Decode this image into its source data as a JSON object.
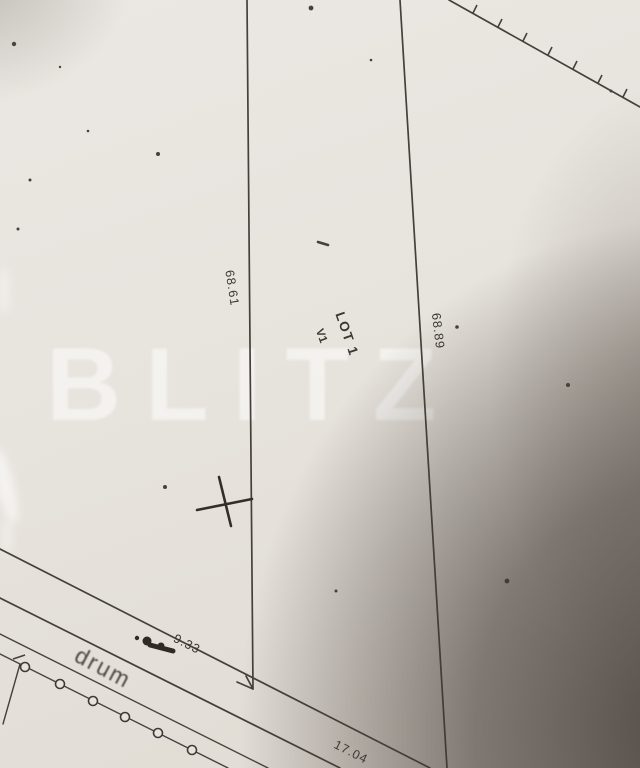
{
  "watermark": {
    "text": "BLITZ"
  },
  "labels": {
    "lot": "LOT 1",
    "vertex": "V1",
    "road": "drum",
    "left_side_length": "68.61",
    "right_side_length": "68.89",
    "road_segment_length": "9.33",
    "frontage_length": "17.04"
  },
  "colors": {
    "paper": "#e7e3dd",
    "ink": "#46403a",
    "camera_shadow": "#3e3630",
    "watermark": "rgba(255,255,255,0.52)"
  }
}
